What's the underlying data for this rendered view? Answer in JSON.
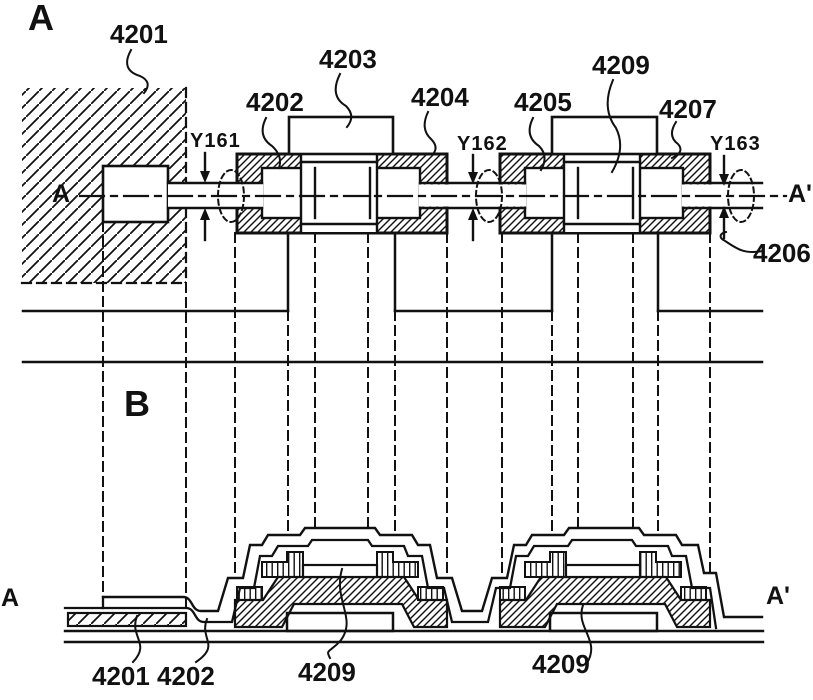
{
  "figure": {
    "view_a": {
      "fig_label": "A",
      "section_marker_left": "A",
      "section_marker_right": "A'",
      "ref_labels": {
        "n4201": "4201",
        "n4202": "4202",
        "n4203": "4203",
        "n4204": "4204",
        "n4205": "4205",
        "n4206": "4206",
        "n4207": "4207",
        "n4209": "4209"
      },
      "dimension_labels": {
        "y161": "Y161",
        "y162": "Y162",
        "y163": "Y163"
      }
    },
    "view_b": {
      "fig_label": "B",
      "section_marker_left": "A",
      "section_marker_right": "A'",
      "ref_labels": {
        "n4201": "4201",
        "n4202": "4202",
        "n4209_left": "4209",
        "n4209_right": "4209"
      }
    },
    "colors": {
      "ink": "#111111",
      "paper": "#ffffff"
    }
  }
}
